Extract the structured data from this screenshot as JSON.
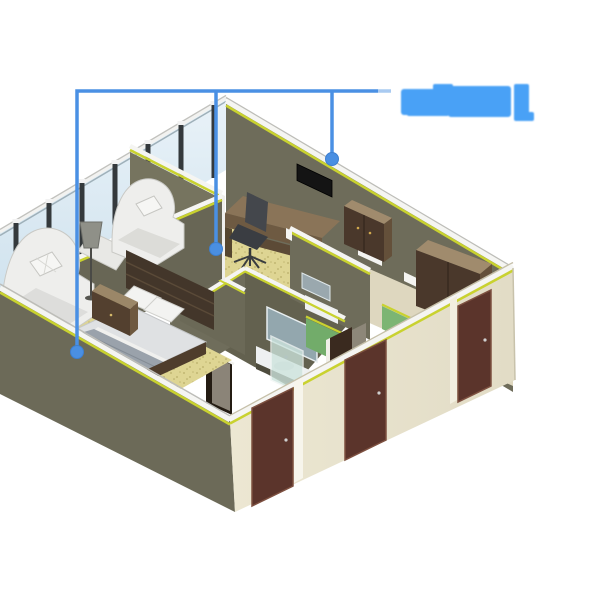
{
  "scene": {
    "type": "isometric-building-cutaway",
    "subject": "hotel-guest-rooms-section-model",
    "callout_count": 3
  },
  "annotation": {
    "line_color": "#4a90e4",
    "line_tail_color": "#a9caf1",
    "dot_color": "#4a8fe2",
    "dot_edge_color": "#3d7fd0",
    "label_blob_color": "#49a1f6",
    "label_legible": false
  },
  "colors": {
    "bg": "#ffffff",
    "glass_blue_light": "#e7f1f7",
    "glass_blue": "#d4e6f0",
    "mullion_dark": "#34393c",
    "trim_white": "#f5f5f2",
    "trim_yellow": "#c9d22f",
    "trim_gray": "#bdbdb8",
    "wall_olive": "#6c6a58",
    "wall_olive_light": "#76745f",
    "wall_olive_mid": "#6e6c5a",
    "wall_olive_dark": "#686655",
    "wall_olive_deep": "#615f4e",
    "interior_dark": "#63614f",
    "wall_cream": "#eae5cf",
    "wall_cream_shade": "#ded7bf",
    "door_brown": "#5b342b",
    "door_brown_dark": "#3a2a1f",
    "wood_top_tan": "#a08b6d",
    "wood_front": "#4a382b",
    "wood_side": "#64503a",
    "desk_top": "#8a7458",
    "desk_front": "#6e5a42",
    "carpet_yellow": "#ded593",
    "carpet_dot": "#a0934c",
    "green_wall": "#72ac6a",
    "green_wall_light": "#7cb573",
    "sofa_white": "#eeeeec",
    "mattress_white": "#dfe1e3",
    "blanket_gray": "#9aa2ab",
    "headboard_brown": "#43362a",
    "rail_brown": "#4f3d2c",
    "nightstand_front": "#53402f",
    "nightstand_top": "#9b8768",
    "tv_black": "#141414",
    "chair_gray": "#44474c",
    "mirror_blue": "#93a7ae",
    "counter_white": "#eef0f1",
    "counter_tan": "#b4a489",
    "lamp_gray": "#8f9088",
    "shower_glass": "#cde4dd"
  }
}
